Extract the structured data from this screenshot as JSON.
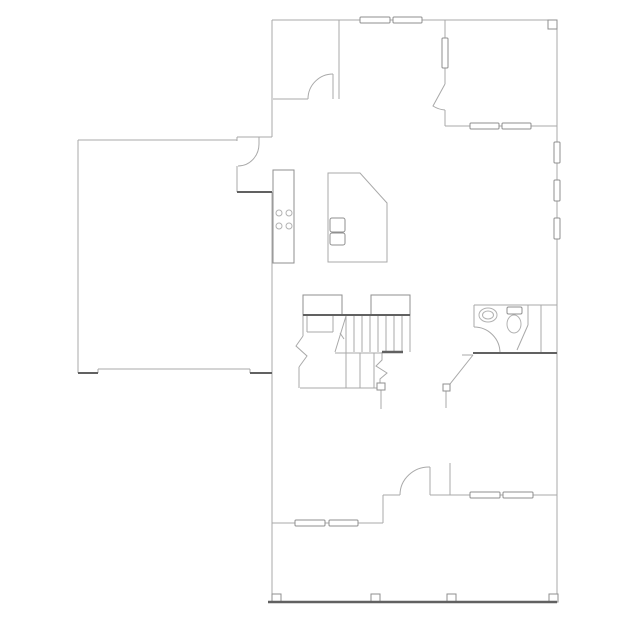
{
  "canvas": {
    "width": 639,
    "height": 639,
    "background": "#ffffff"
  },
  "colors": {
    "line_light": "#a9a9a9",
    "line_medium": "#8f8f8f",
    "line_dark": "#616161",
    "fixture": "#b2b2b2",
    "fill": "#ffffff"
  },
  "geometry": {
    "lines_light": [
      {
        "name": "wall-top",
        "p": [
          272,
          20,
          557,
          20
        ]
      },
      {
        "name": "wall-left-upper",
        "p": [
          272,
          20,
          272,
          137
        ]
      },
      {
        "name": "wall-connector",
        "p": [
          237,
          137,
          272,
          137
        ]
      },
      {
        "name": "wall-connector-step",
        "p": [
          237,
          137,
          237,
          141
        ]
      },
      {
        "name": "wall-garage-top",
        "p": [
          78,
          140,
          237,
          140
        ]
      },
      {
        "name": "wall-garage-left",
        "p": [
          78,
          140,
          78,
          373
        ]
      },
      {
        "name": "garage-door-line",
        "p": [
          98,
          369,
          250,
          369
        ]
      },
      {
        "name": "garage-door-jamb-left",
        "p": [
          98,
          369,
          98,
          373
        ]
      },
      {
        "name": "garage-door-jamb-right",
        "p": [
          250,
          369,
          250,
          373
        ]
      },
      {
        "name": "wall-house-left",
        "p": [
          272,
          192,
          272,
          602
        ]
      },
      {
        "name": "wall-right",
        "p": [
          557,
          20,
          557,
          602
        ]
      },
      {
        "name": "wall-upperroom-right",
        "p": [
          339,
          20,
          339,
          99
        ]
      },
      {
        "name": "wall-upperroom-bottom",
        "p": [
          273,
          99,
          308,
          99
        ]
      },
      {
        "name": "door-leaf-upperroom",
        "p": [
          333,
          74,
          333,
          99
        ]
      },
      {
        "name": "wall-interior-top-a",
        "p": [
          445,
          20,
          445,
          38
        ]
      },
      {
        "name": "wall-interior-top-b",
        "p": [
          445,
          68,
          445,
          84
        ]
      },
      {
        "name": "wall-interior-top-c",
        "p": [
          445,
          110,
          445,
          126
        ]
      },
      {
        "name": "wall-rightroom-bottom",
        "p": [
          445,
          126,
          557,
          126
        ]
      },
      {
        "name": "wall-bathroom-top",
        "p": [
          474,
          305,
          557,
          305
        ]
      },
      {
        "name": "wall-bathroom-left",
        "p": [
          474,
          305,
          474,
          327
        ]
      },
      {
        "name": "wall-bath-partition",
        "p": [
          528,
          305,
          528,
          325
        ]
      },
      {
        "name": "wall-bath-closet",
        "p": [
          541,
          305,
          541,
          353
        ]
      },
      {
        "name": "door-leaf-front",
        "p": [
          430,
          467,
          430,
          495
        ]
      },
      {
        "name": "wall-front-right",
        "p": [
          430,
          495,
          557,
          495
        ]
      },
      {
        "name": "wall-entry-stub",
        "p": [
          450,
          463,
          450,
          495
        ]
      },
      {
        "name": "wall-front-mid",
        "p": [
          383,
          495,
          400,
          495
        ]
      },
      {
        "name": "wall-front-step",
        "p": [
          383,
          495,
          383,
          523
        ]
      },
      {
        "name": "wall-front-left",
        "p": [
          272,
          523,
          383,
          523
        ]
      },
      {
        "name": "door-jamb-garage",
        "p": [
          259,
          137,
          259,
          144
        ]
      },
      {
        "name": "wall-garage-stub",
        "p": [
          237,
          166,
          237,
          192
        ]
      },
      {
        "name": "wall-bath-ext",
        "p": [
          462,
          355,
          473,
          355
        ]
      },
      {
        "name": "door-symbol-line-bath",
        "p": [
          446,
          391,
          446,
          408
        ]
      },
      {
        "name": "door-symbol-line-stairs",
        "p": [
          381,
          390,
          381,
          409
        ]
      },
      {
        "name": "stair-stringer",
        "p": [
          346,
          315,
          346,
          388
        ]
      },
      {
        "name": "stair-tread",
        "p": [
          354,
          315,
          354,
          352
        ]
      },
      {
        "name": "stair-tread",
        "p": [
          362,
          315,
          362,
          352
        ]
      },
      {
        "name": "stair-tread",
        "p": [
          370,
          315,
          370,
          352
        ]
      },
      {
        "name": "stair-tread",
        "p": [
          378,
          315,
          378,
          352
        ]
      },
      {
        "name": "stair-tread",
        "p": [
          386,
          315,
          386,
          352
        ]
      },
      {
        "name": "stair-tread",
        "p": [
          394,
          315,
          394,
          352
        ]
      },
      {
        "name": "stair-tread",
        "p": [
          402,
          315,
          402,
          352
        ]
      },
      {
        "name": "stair-edge-right",
        "p": [
          410,
          315,
          410,
          352
        ]
      },
      {
        "name": "stair-mid-line",
        "p": [
          335,
          353,
          382,
          353
        ]
      },
      {
        "name": "stair-tread-lower",
        "p": [
          360,
          353,
          360,
          388
        ]
      },
      {
        "name": "stair-tread-lower",
        "p": [
          374,
          353,
          374,
          388
        ]
      },
      {
        "name": "stair-bottom-line",
        "p": [
          300,
          388,
          385,
          388
        ]
      },
      {
        "name": "stair-left-edge",
        "p": [
          303,
          315,
          303,
          336
        ]
      },
      {
        "name": "stair-landing-left",
        "p": [
          307,
          315,
          307,
          332
        ]
      },
      {
        "name": "stair-landing-right",
        "p": [
          333,
          315,
          333,
          332
        ]
      },
      {
        "name": "stair-landing-bottom",
        "p": [
          307,
          332,
          333,
          332
        ]
      },
      {
        "name": "stair-left-lower-edge",
        "p": [
          299,
          367,
          299,
          388
        ]
      },
      {
        "name": "stair-direction-line",
        "p": [
          346,
          316,
          335,
          352
        ]
      },
      {
        "name": "stair-direction-tick",
        "p": [
          340,
          333,
          344,
          339
        ]
      },
      {
        "name": "counter-division",
        "p": [
          273,
          207,
          294,
          207
        ]
      },
      {
        "name": "counter-division",
        "p": [
          273,
          233,
          294,
          233
        ]
      }
    ],
    "lines_dark": [
      {
        "name": "wall-garage-bottom-left",
        "p": [
          78,
          373,
          98,
          373
        ],
        "w": 2
      },
      {
        "name": "wall-garage-bottom-right",
        "p": [
          250,
          373,
          272,
          373
        ],
        "w": 2
      },
      {
        "name": "wall-kitchen-garage",
        "p": [
          237,
          192,
          272,
          192
        ],
        "w": 2
      },
      {
        "name": "stair-top-edge",
        "p": [
          303,
          315,
          410,
          315
        ],
        "w": 2
      },
      {
        "name": "stair-dark-bar",
        "p": [
          382,
          352,
          403,
          352
        ],
        "w": 2.5
      },
      {
        "name": "wall-bathroom-bottom",
        "p": [
          473,
          353,
          557,
          353
        ],
        "w": 2
      },
      {
        "name": "porch-edge",
        "p": [
          268,
          602,
          557,
          602
        ],
        "w": 2.5
      }
    ],
    "paths_light": [
      {
        "name": "door-arc-upperroom",
        "d": "M308,99 A25,25 0 0 1 333,74"
      },
      {
        "name": "door-arc-garage",
        "d": "M259,144 A21,22 0 0 1 238,166"
      },
      {
        "name": "door-leaf-rightroom",
        "d": "M445,84 L433,106 A25,25 0 0 0 445,110"
      },
      {
        "name": "door-arc-bathroom",
        "d": "M474,327 A26,26 0 0 1 500,353"
      },
      {
        "name": "door-arc-front",
        "d": "M400,495 A29,28 0 0 1 430,467"
      },
      {
        "name": "bath-partition-diagonal",
        "d": "M528,325 L517,350"
      },
      {
        "name": "door-symbol-diagonal-bath",
        "d": "M473,355 L450,384"
      },
      {
        "name": "stairs-break-left",
        "d": "M303,336 L296,346 L307,356 L299,367"
      },
      {
        "name": "stairs-break-right",
        "d": "M382,352 L382,360 L376,366 L387,373 L380,379 L380,383"
      },
      {
        "name": "kitchen-island",
        "d": "M328,173 L360,173 L387,203 L387,262 L328,262 Z"
      }
    ],
    "windows": [
      {
        "name": "window-top-1",
        "x": 360,
        "y": 17,
        "w": 30,
        "h": 6
      },
      {
        "name": "window-top-2",
        "x": 393,
        "y": 17,
        "w": 29,
        "h": 6
      },
      {
        "name": "window-interior-wall",
        "x": 442,
        "y": 38,
        "w": 6,
        "h": 30
      },
      {
        "name": "window-rightroom-1",
        "x": 470,
        "y": 123,
        "w": 29,
        "h": 6
      },
      {
        "name": "window-rightroom-2",
        "x": 502,
        "y": 123,
        "w": 29,
        "h": 6
      },
      {
        "name": "window-right-1",
        "x": 554,
        "y": 142,
        "w": 6,
        "h": 21
      },
      {
        "name": "window-right-2",
        "x": 554,
        "y": 180,
        "w": 6,
        "h": 21
      },
      {
        "name": "window-right-3",
        "x": 554,
        "y": 218,
        "w": 6,
        "h": 21
      },
      {
        "name": "window-front-1",
        "x": 470,
        "y": 492,
        "w": 30,
        "h": 6
      },
      {
        "name": "window-front-2",
        "x": 503,
        "y": 492,
        "w": 30,
        "h": 6
      },
      {
        "name": "window-frontleft-1",
        "x": 295,
        "y": 520,
        "w": 30,
        "h": 6
      },
      {
        "name": "window-frontleft-2",
        "x": 329,
        "y": 520,
        "w": 29,
        "h": 6
      }
    ],
    "boxes": [
      {
        "name": "kitchen-counter",
        "x": 273,
        "y": 170,
        "w": 21,
        "h": 93,
        "rx": 0
      },
      {
        "name": "stair-newel-left",
        "x": 303,
        "y": 295,
        "w": 39,
        "h": 20,
        "rx": 0
      },
      {
        "name": "stair-newel-right",
        "x": 371,
        "y": 295,
        "w": 39,
        "h": 20,
        "rx": 0
      },
      {
        "name": "toilet-tank",
        "x": 507,
        "y": 307,
        "w": 15,
        "h": 7,
        "rx": 1.5
      },
      {
        "name": "island-sink-upper",
        "x": 330,
        "y": 218,
        "w": 15,
        "h": 14,
        "rx": 2
      },
      {
        "name": "island-sink-lower",
        "x": 330,
        "y": 233,
        "w": 15,
        "h": 12,
        "rx": 2
      },
      {
        "name": "corner-post",
        "x": 548,
        "y": 20,
        "w": 9,
        "h": 9,
        "rx": 0
      },
      {
        "name": "door-symbol-square-stairs",
        "x": 377,
        "y": 383,
        "w": 8,
        "h": 7,
        "rx": 0
      },
      {
        "name": "door-symbol-square-bath",
        "x": 443,
        "y": 384,
        "w": 7,
        "h": 7,
        "rx": 0
      },
      {
        "name": "porch-post",
        "x": 272,
        "y": 594,
        "w": 9,
        "h": 8,
        "rx": 0
      },
      {
        "name": "porch-post",
        "x": 371,
        "y": 594,
        "w": 9,
        "h": 8,
        "rx": 0
      },
      {
        "name": "porch-post",
        "x": 447,
        "y": 594,
        "w": 9,
        "h": 8,
        "rx": 0
      },
      {
        "name": "porch-post",
        "x": 549,
        "y": 594,
        "w": 9,
        "h": 8,
        "rx": 0
      }
    ],
    "ellipses": [
      {
        "name": "bathroom-sink-outer",
        "cx": 488,
        "cy": 315,
        "rx": 9,
        "ry": 7
      },
      {
        "name": "bathroom-sink-inner",
        "cx": 488,
        "cy": 315,
        "rx": 5.5,
        "ry": 4
      },
      {
        "name": "toilet-bowl",
        "cx": 514,
        "cy": 324,
        "rx": 7,
        "ry": 9
      }
    ],
    "circles": [
      {
        "name": "stove-burner",
        "cx": 279,
        "cy": 213,
        "r": 3
      },
      {
        "name": "stove-burner",
        "cx": 289,
        "cy": 213,
        "r": 3
      },
      {
        "name": "stove-burner",
        "cx": 279,
        "cy": 226,
        "r": 3
      },
      {
        "name": "stove-burner",
        "cx": 289,
        "cy": 226,
        "r": 3
      }
    ]
  }
}
